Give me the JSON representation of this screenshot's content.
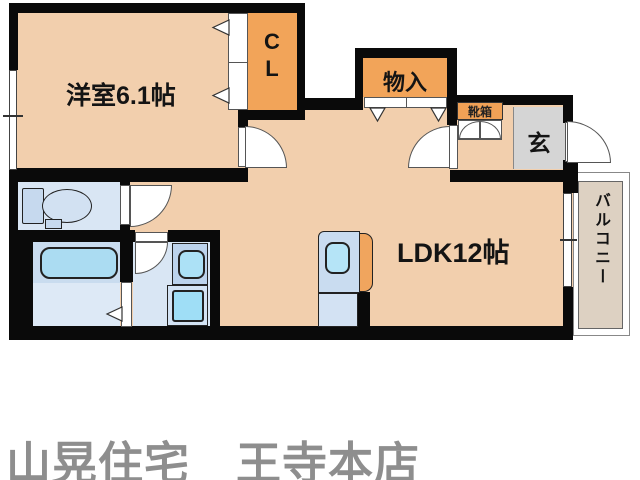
{
  "floorplan": {
    "labels": {
      "western_room": "洋室6.1帖",
      "ldk": "LDK12帖",
      "closet_line1": "C",
      "closet_line2": "L",
      "storage": "物入",
      "shoe_box": "靴箱",
      "entrance": "玄",
      "balcony": "バルコニー"
    },
    "colors": {
      "floor_peach": "#f2cfad",
      "closet_orange": "#f2a459",
      "entrance_gray": "#d5d5d5",
      "balcony_tan": "#ddd1c2",
      "wet_room_blue": "#d9e6f4",
      "fixture_cyan": "#a5def4",
      "wall_black": "#0a0a0a",
      "footer_gray": "#8e8e8e"
    }
  },
  "footer": {
    "brand": "山晃住宅　王寺本店"
  }
}
